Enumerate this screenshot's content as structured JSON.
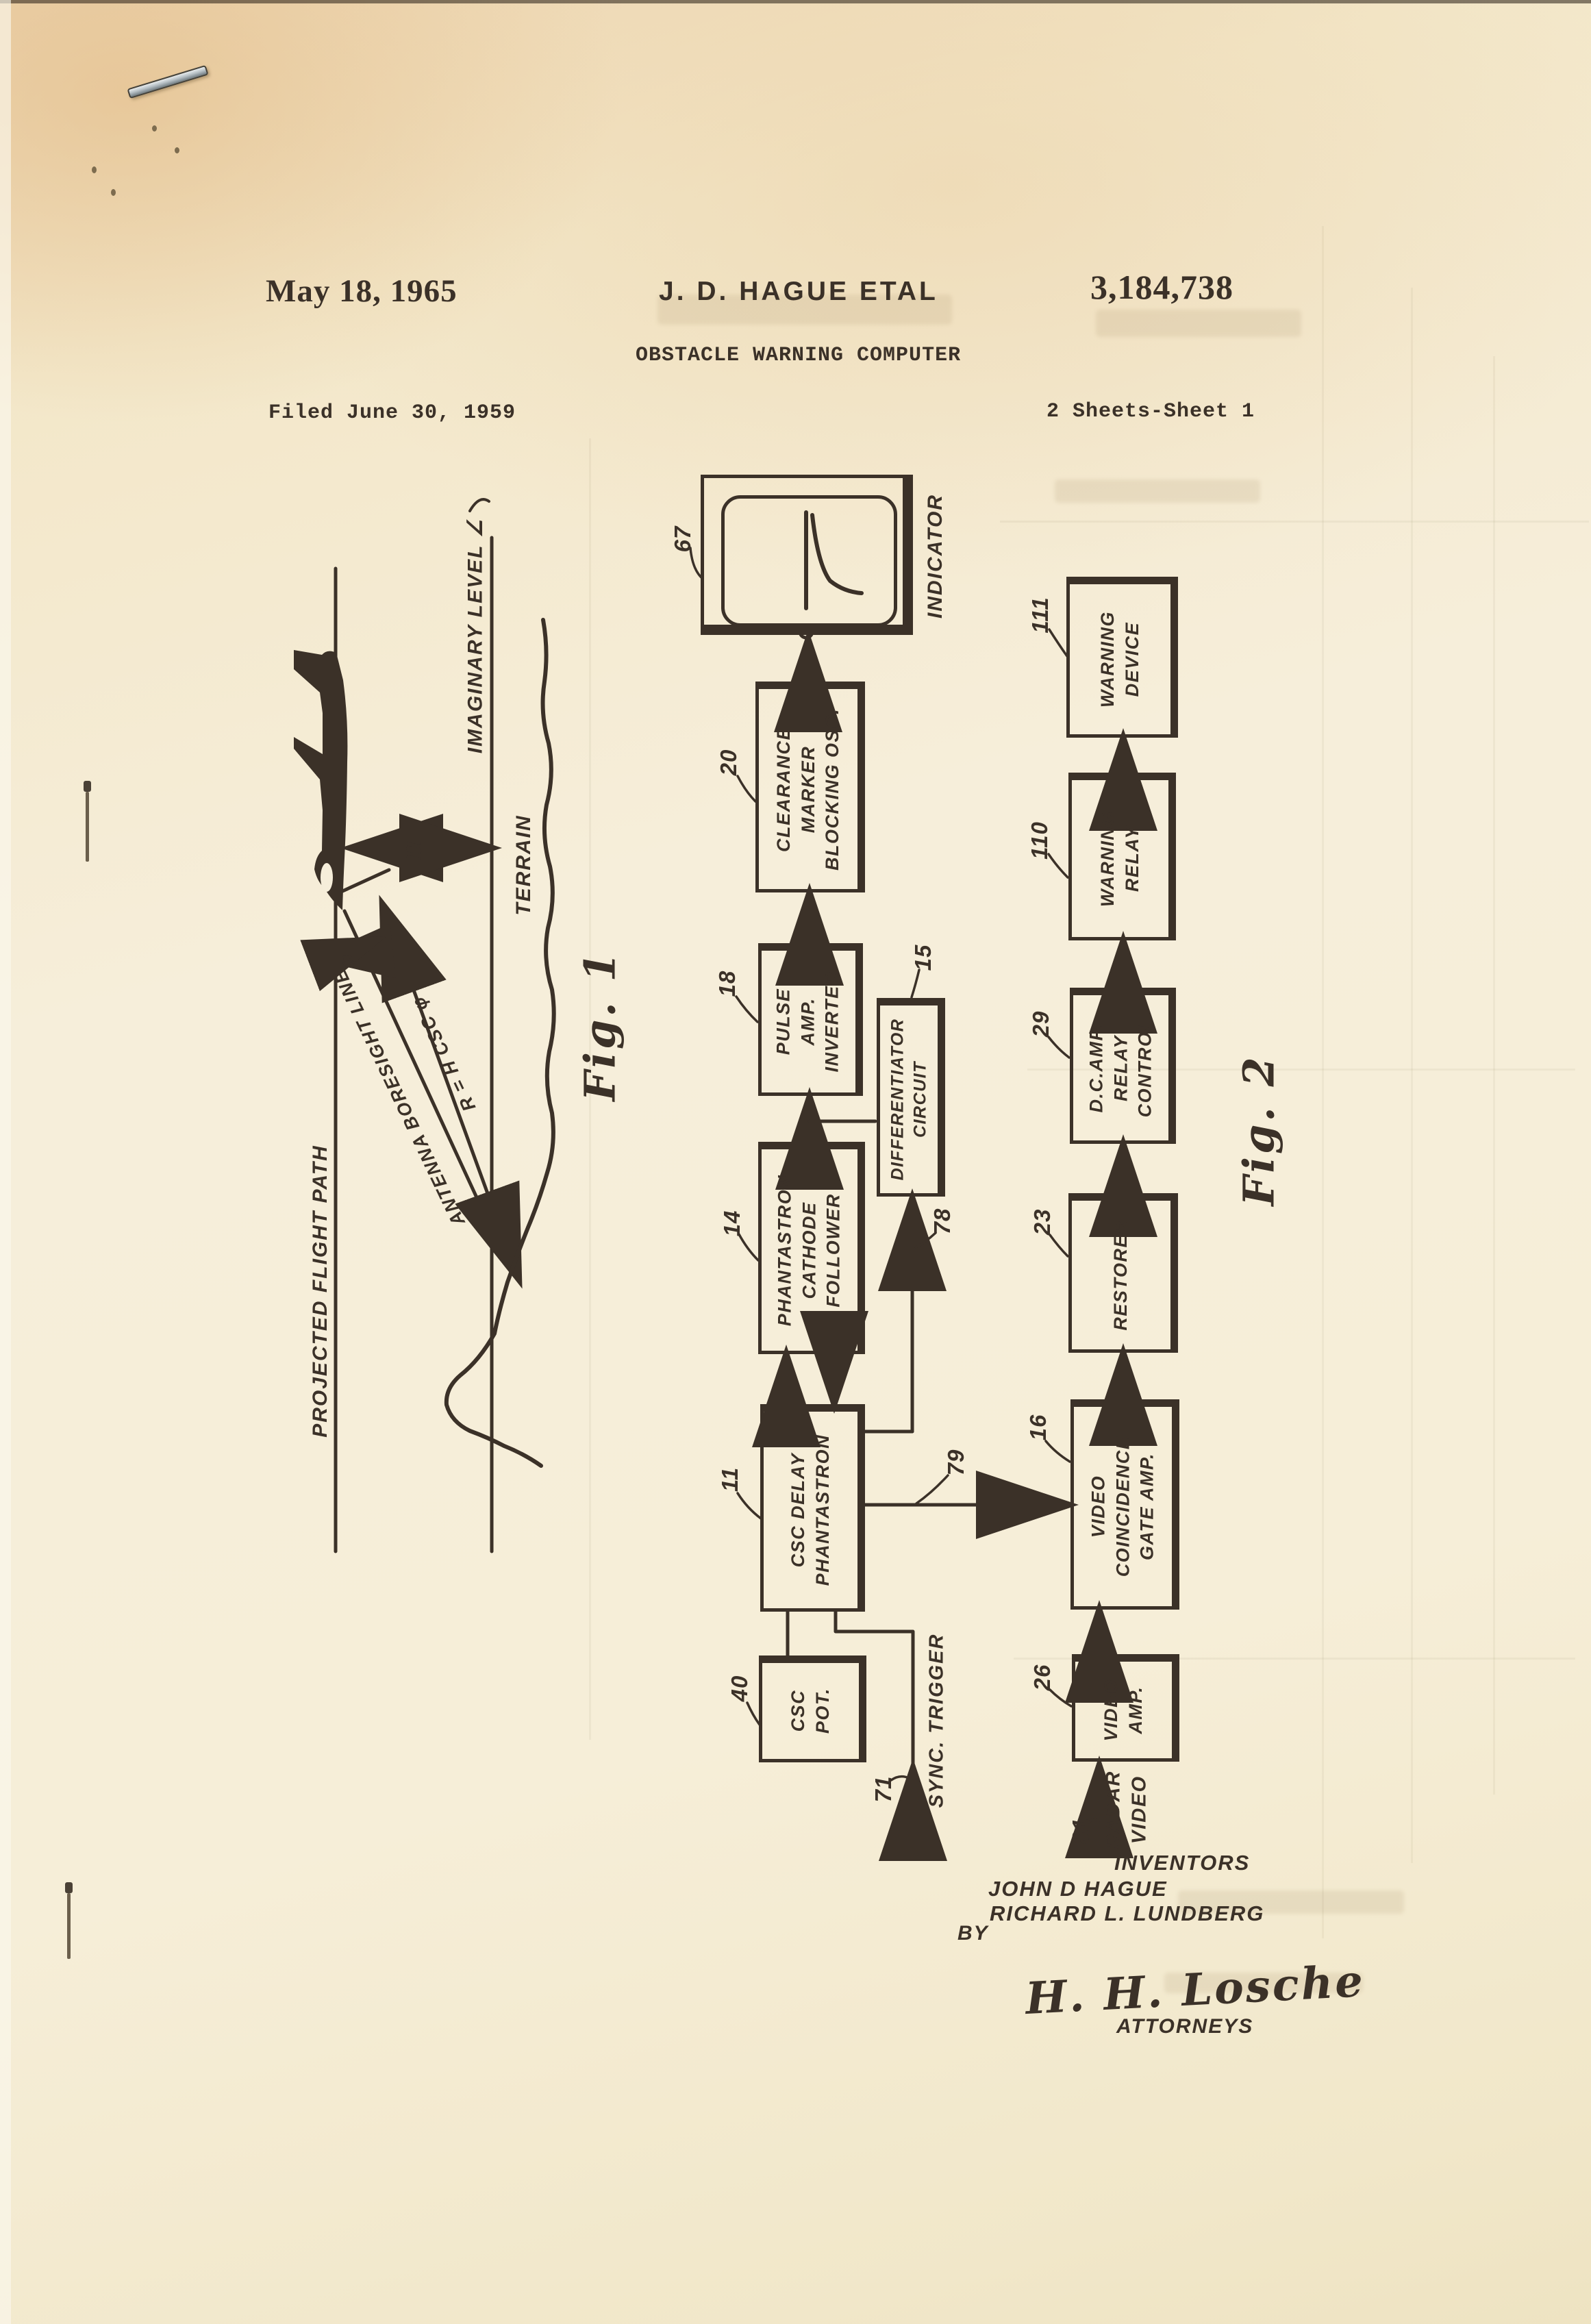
{
  "header": {
    "date": "May 18, 1965",
    "author": "J. D. HAGUE ETAL",
    "patent_number": "3,184,738",
    "title": "OBSTACLE WARNING COMPUTER",
    "filed": "Filed June 30, 1959",
    "sheet": "2 Sheets-Sheet 1"
  },
  "fig1": {
    "label": "Fig. 1",
    "flight_path": "PROJECTED FLIGHT PATH",
    "imaginary_level": "IMAGINARY LEVEL ∠",
    "terrain": "TERRAIN",
    "boresight": "ANTENNA BORESIGHT LINE",
    "range_formula": "R = H CSC φ",
    "height_symbol": "H",
    "angle_symbol": "φ"
  },
  "fig2": {
    "label": "Fig. 2",
    "indicator": {
      "ref": "67",
      "name": "INDICATOR"
    },
    "blocks": [
      {
        "ref": "20",
        "label": "CLEARANCE\nMARKER\nBLOCKING OSC."
      },
      {
        "ref": "18",
        "label": "PULSE\nAMP.\nINVERTER"
      },
      {
        "ref": "15",
        "label": "DIFFERENTIATOR\nCIRCUIT"
      },
      {
        "ref": "14",
        "label": "PHANTASTRON\nCATHODE\nFOLLOWER"
      },
      {
        "ref": "11",
        "label": "CSC DELAY\nPHANTASTRON"
      },
      {
        "ref": "40",
        "label": "CSC\nPOT."
      },
      {
        "ref": "111",
        "label": "WARNING\nDEVICE"
      },
      {
        "ref": "110",
        "label": "WARNING\nRELAY"
      },
      {
        "ref": "29",
        "label": "D.C.AMP.\nRELAY\nCONTROL"
      },
      {
        "ref": "23",
        "label": "RESTORER"
      },
      {
        "ref": "16",
        "label": "VIDEO\nCOINCIDENCE\nGATE AMP."
      },
      {
        "ref": "26",
        "label": "VIDEO\nAMP."
      }
    ],
    "signals": {
      "sync_trigger": {
        "ref": "71",
        "label": "SYNC. TRIGGER"
      },
      "radar_video": {
        "ref": "81",
        "label": "RADAR\nVIDEO"
      },
      "line_78": "78",
      "line_79": "79"
    }
  },
  "footer": {
    "inventors_heading": "INVENTORS",
    "inventor_1": "JOHN D HAGUE",
    "inventor_2": "RICHARD L. LUNDBERG",
    "by": "BY",
    "signature": "H. H. Losche",
    "attorneys": "ATTORNEYS"
  }
}
